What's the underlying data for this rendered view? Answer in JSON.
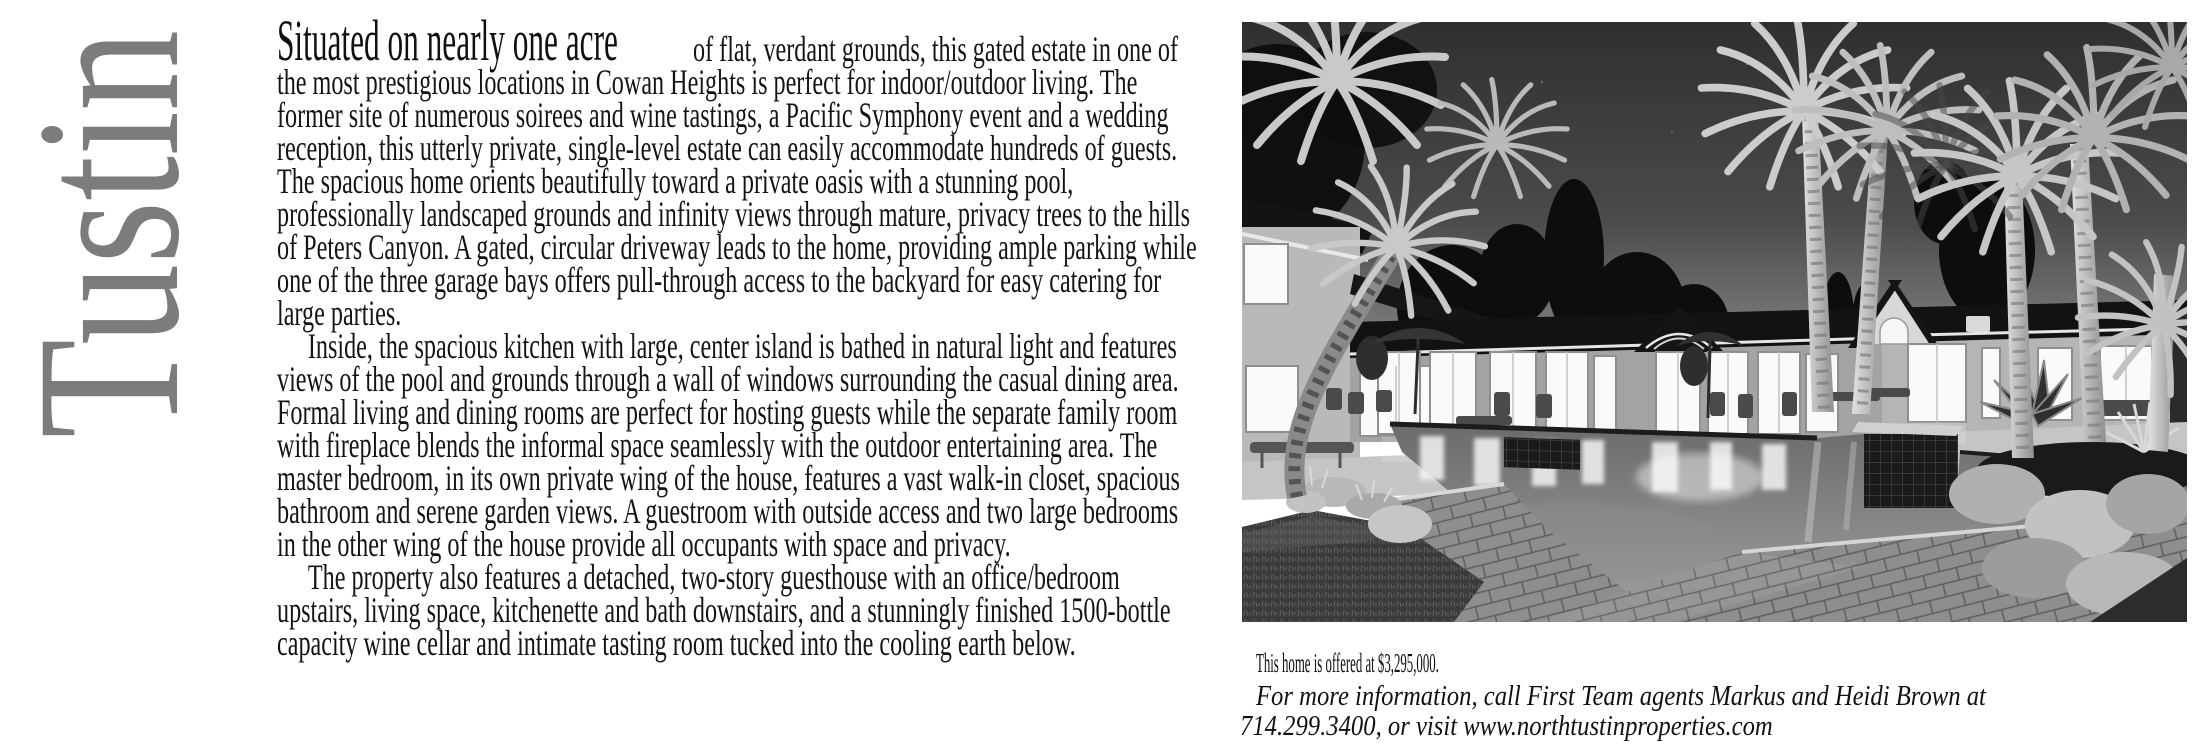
{
  "masthead": {
    "city_label": "Tustin"
  },
  "article": {
    "lead_in": "Situated on nearly one acre",
    "paragraph_1": "of flat, verdant grounds, this gated estate in one of the most prestigious locations in Cowan Heights is perfect for indoor/outdoor living. The former site of numerous soirees and wine tastings, a Pacific Symphony event and a wedding reception, this utterly private, single-level estate can easily accommodate hundreds of guests. The spacious home orients beautifully toward a private oasis with a stunning pool, professionally landscaped grounds and infinity views through mature, privacy trees to the hills of Peters Canyon. A gated, circular driveway leads to the home, providing ample parking while one of the three garage bays offers pull-through access to the backyard for easy catering for large parties.",
    "paragraph_2": "Inside, the spacious kitchen with large, center island is bathed in natural light and features views of the pool and grounds through a wall of windows surrounding the casual dining area. Formal living and dining rooms are perfect for hosting guests while the separate family room with fireplace blends the informal space seamlessly with the outdoor entertaining area. The master bedroom, in its own private wing of the house, features a vast walk-in closet, spacious bathroom and serene garden views. A guestroom with outside access and two large bedrooms in the other wing of the house provide all occupants with space and privacy.",
    "paragraph_3": "The property also features a detached, two-story guesthouse with an office/bedroom upstairs, living space, kitchenette and bath downstairs, and a stunningly finished 1500-bottle capacity wine cellar and intimate tasting room tucked into the cooling earth below."
  },
  "listing": {
    "offer_text": "This home is offered at $3,295,000.",
    "contact_line_1": "For more information, call First Team agents Markus and Heidi Brown at",
    "contact_line_2": "714.299.3400, or visit www.northtustinproperties.com",
    "price": "$3,295,000",
    "agents": "Markus and Heidi Brown",
    "brokerage": "First Team",
    "phone": "714.299.3400",
    "website": "www.northtustinproperties.com"
  },
  "colors": {
    "city_label_gray": "#7c7c7c",
    "body_text": "#141414",
    "paper": "#ffffff",
    "photo_sky_top": "#2f2f31",
    "photo_sky_horizon": "#8f8f90",
    "photo_window_glow": "#fafafa"
  }
}
